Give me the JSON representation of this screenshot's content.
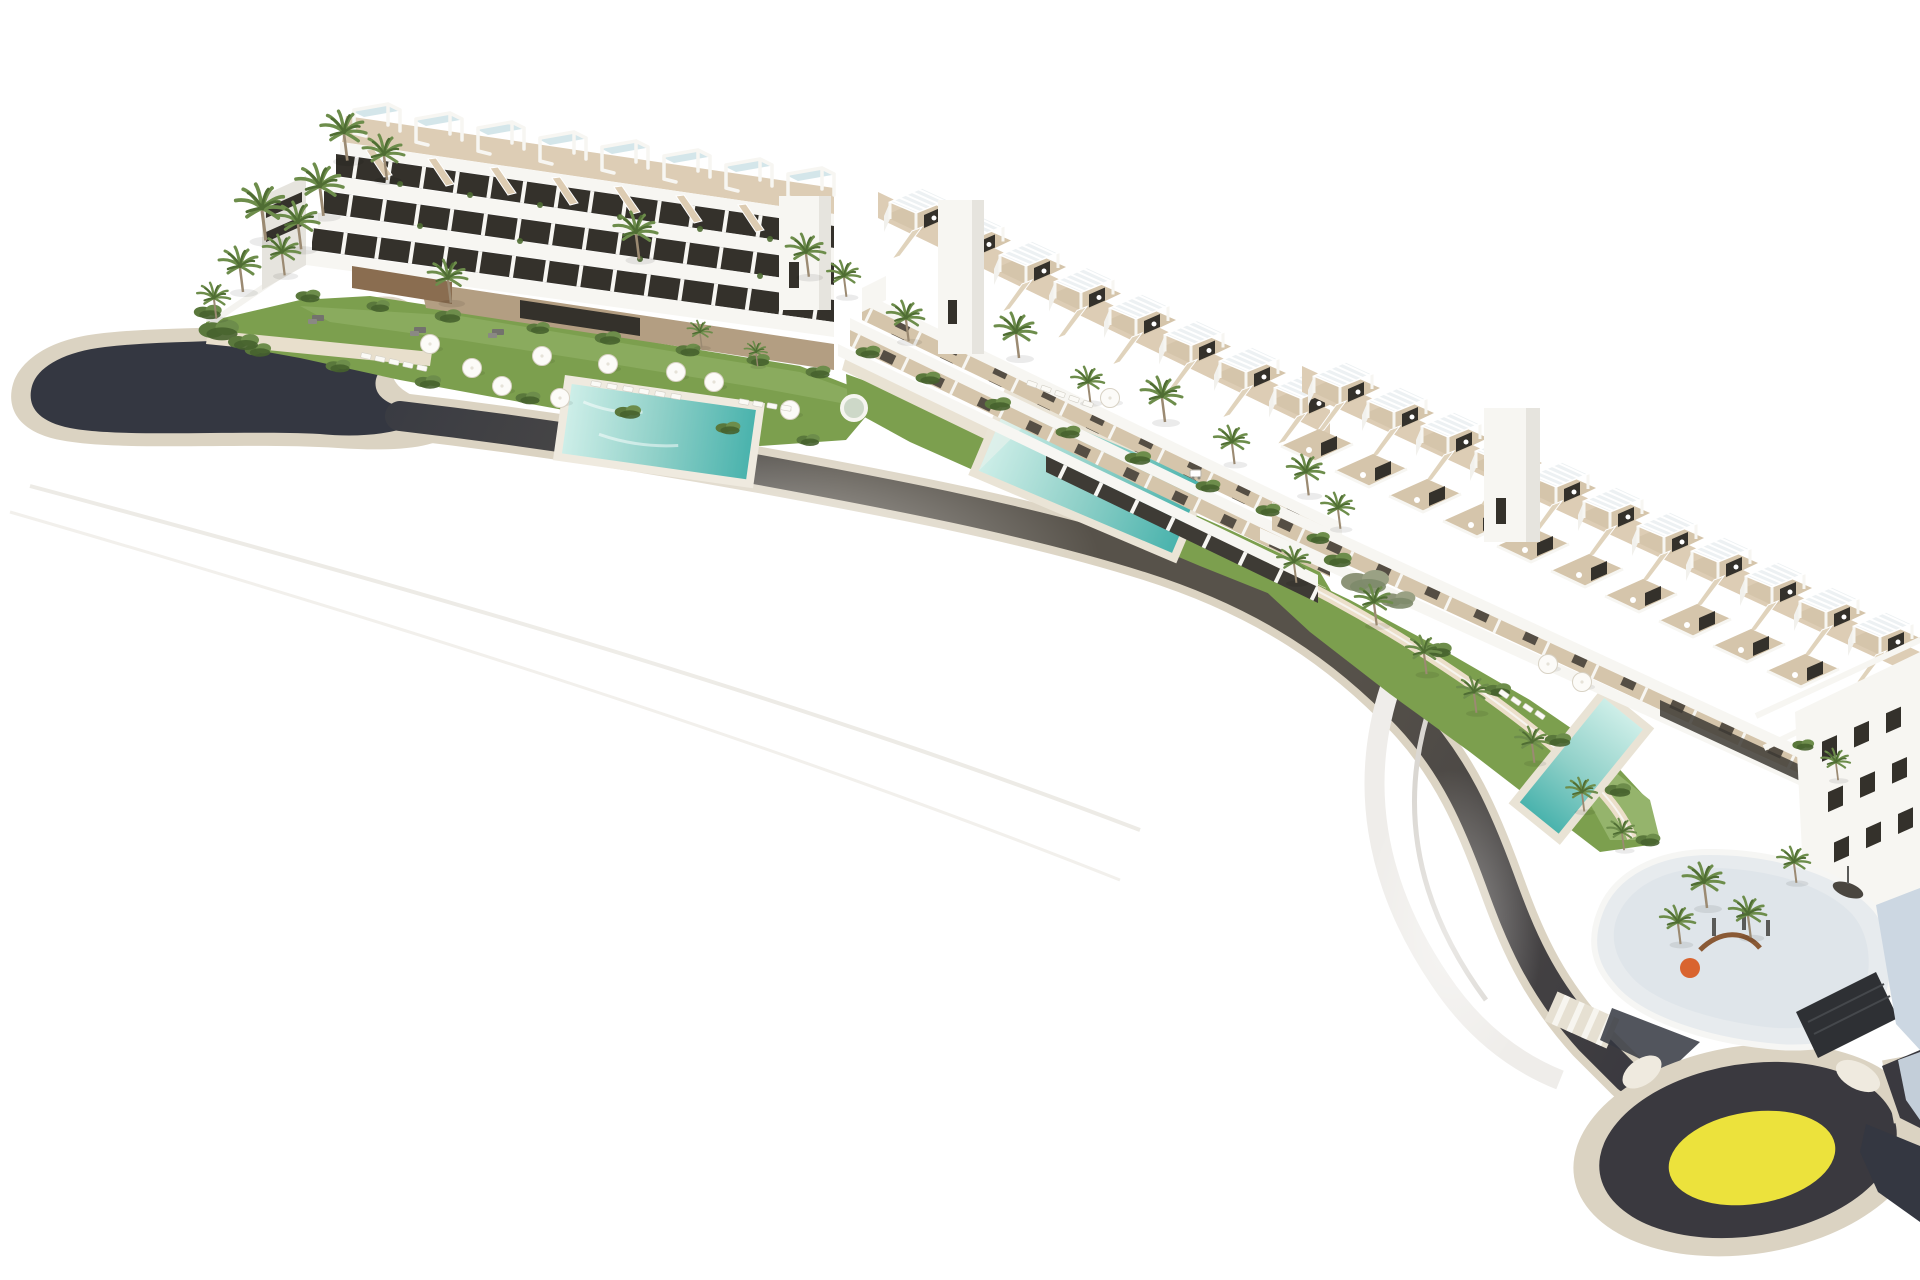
{
  "scene": {
    "type": "architectural-aerial-render",
    "description": "Aerial 3D architectural rendering of a white coastal residential complex: three terraced apartment blocks with rooftop pergola terraces, landscaped gardens with three turquoise swimming pools, palm trees, white parasols and sun loungers, a dark curving access road with cream sidewalks running from a western cul-de-sac to a southeastern roundabout with a yellow centre island, a playground podium with orange play equipment, all isolated on a plain white background.",
    "background": "plain white",
    "no_visible_text": true
  },
  "colors": {
    "background": "#ffffff",
    "asphalt": "#3a393f",
    "asphalt-deep": "#343741",
    "asphalt-warm": "#57524a",
    "sidewalk": "#dbd3c2",
    "sidewalk-light": "#efeadf",
    "path": "#e8dfcc",
    "lawn": "#7c9f4e",
    "lawn-light": "#95b46c",
    "shrub": "#5a783c",
    "shrub-dark": "#46622e",
    "shrub-gray": "#8d9478",
    "pool": "#8fd0c8",
    "pool-deep": "#4ab3ad",
    "pool-light": "#cdeee8",
    "deck": "#d5c5ab",
    "deck-light": "#ddcdb5",
    "building-white": "#f7f6f2",
    "building-shade": "#e6e4de",
    "shaded-wall": "#ccd7e2",
    "window": "#34312b",
    "stone": "#b39e82",
    "stone-dark": "#8a6d50",
    "trunk": "#9b8a72",
    "palm": "#6d8d4b",
    "palm-dark": "#4f6d33",
    "yellow": "#ece23c",
    "orange": "#d9642f",
    "glass": "#cfe3e8",
    "canopy": "#edf1f3",
    "equipment": "#5a5a58"
  },
  "objects": {
    "buildings": [
      {
        "id": "block-a",
        "position": "north-west",
        "form": "linear 4-storey slab",
        "rooftop_units": 8,
        "features": [
          "rooftop terraces with white pergola frames",
          "glass skylights",
          "roof stairs",
          "white balcony bands with dark glazing",
          "stone-clad base"
        ]
      },
      {
        "id": "block-b",
        "position": "centre",
        "form": "stepped terraced row",
        "rooftop_units": 8,
        "features": [
          "louvered pergolas",
          "tan roof decks",
          "diagonal external stairs",
          "white stair-core tower"
        ]
      },
      {
        "id": "block-c",
        "position": "south-east",
        "form": "stepped terraced row",
        "rooftop_units": 11,
        "features": [
          "louvered pergolas",
          "second terrace row",
          "corner facade with square windows",
          "podium with playground",
          "garage ramp"
        ]
      }
    ],
    "pools": [
      {
        "location": "left garden",
        "shape": "rectangular"
      },
      {
        "location": "middle garden",
        "shape": "rectangular"
      },
      {
        "location": "right garden",
        "shape": "narrow rectangular"
      }
    ],
    "road": {
      "type": "curved single-carriageway access road",
      "surface": "dark asphalt",
      "edges": "cream sidewalks",
      "west_end": "rounded cul-de-sac",
      "east_end": "roundabout",
      "crosswalk": true
    },
    "roundabout": {
      "centre_island_color": "yellow",
      "ring_color": "dark asphalt",
      "exits": 3
    },
    "playground": {
      "accent_color": "orange",
      "location": "south-east podium",
      "palms": true
    },
    "vegetation": {
      "palm_trees": 34,
      "shrub_clusters": 33,
      "lawn_areas": 3
    },
    "furniture": {
      "white_parasols": 12,
      "sun_loungers": 24,
      "grey_lounge_sets": 3,
      "garden_cart": 1
    }
  }
}
